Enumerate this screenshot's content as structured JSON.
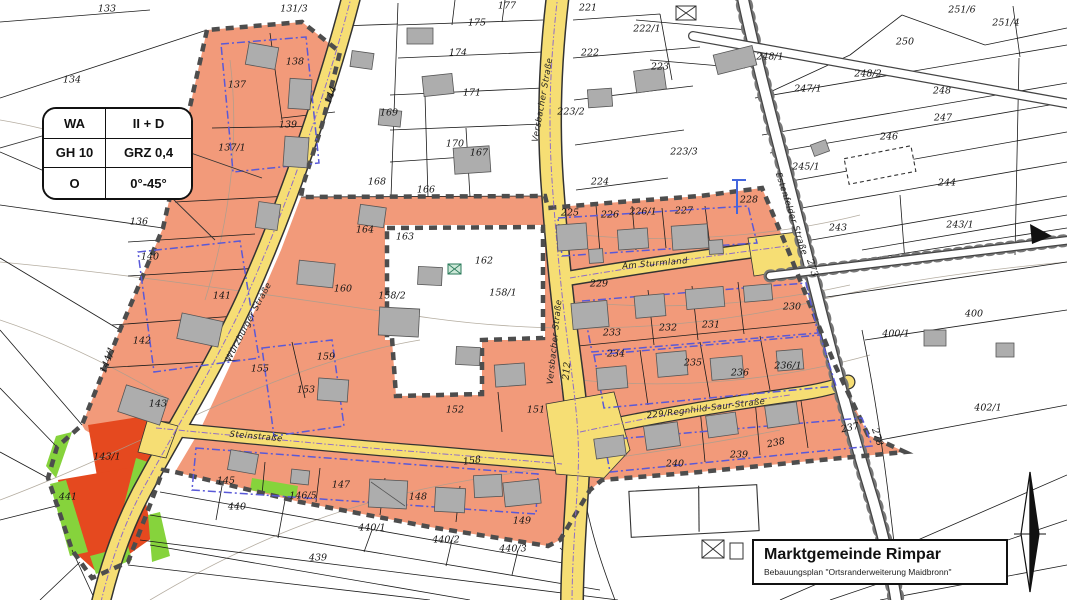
{
  "map": {
    "title_block": {
      "municipality": "Marktgemeinde Rimpar",
      "plan_name": "Bebauungsplan \"Ortsranderweiterung Maidbronn\""
    },
    "legend": {
      "rows": [
        [
          "WA",
          "II + D"
        ],
        [
          "GH 10",
          "GRZ 0,4"
        ],
        [
          "O",
          "0°-45°"
        ]
      ]
    },
    "colors": {
      "zone_orange": "#F29A7A",
      "zone_red": "#E5491F",
      "green_strip": "#86D33C",
      "street_yellow": "#F6DE74",
      "baugrenze_blue": "#5959D8",
      "utility_violet": "#8F6CC8",
      "boundary_gray": "#4D4D4D",
      "building_gray": "#ADADAD"
    },
    "street_labels": [
      {
        "t": "Versbacher Straße",
        "x": 543,
        "y": 100,
        "r": -80
      },
      {
        "t": "Versbacher Straße",
        "x": 555,
        "y": 342,
        "r": -84
      },
      {
        "t": "Würzburger Straße",
        "x": 249,
        "y": 322,
        "r": -62
      },
      {
        "t": "Steinstraße",
        "x": 256,
        "y": 437,
        "r": 5
      },
      {
        "t": "Am Sturmland",
        "x": 655,
        "y": 264,
        "r": -5
      },
      {
        "t": "229/Regnhild-Saur-Straße",
        "x": 706,
        "y": 409,
        "r": -7
      },
      {
        "t": "Estenfelder Straße",
        "x": 791,
        "y": 214,
        "r": 72
      }
    ],
    "parcel_labels": [
      {
        "t": "133",
        "x": 107,
        "y": 9
      },
      {
        "t": "134",
        "x": 72,
        "y": 80
      },
      {
        "t": "131/3",
        "x": 294,
        "y": 9
      },
      {
        "t": "177",
        "x": 507,
        "y": 6
      },
      {
        "t": "175",
        "x": 477,
        "y": 23
      },
      {
        "t": "174",
        "x": 458,
        "y": 53
      },
      {
        "t": "171",
        "x": 472,
        "y": 93
      },
      {
        "t": "169",
        "x": 389,
        "y": 113
      },
      {
        "t": "170",
        "x": 455,
        "y": 144
      },
      {
        "t": "167",
        "x": 479,
        "y": 153
      },
      {
        "t": "168",
        "x": 377,
        "y": 182
      },
      {
        "t": "166",
        "x": 426,
        "y": 190
      },
      {
        "t": "221",
        "x": 588,
        "y": 8
      },
      {
        "t": "222",
        "x": 590,
        "y": 53
      },
      {
        "t": "222/1",
        "x": 647,
        "y": 29
      },
      {
        "t": "223",
        "x": 660,
        "y": 67
      },
      {
        "t": "223/2",
        "x": 571,
        "y": 112
      },
      {
        "t": "223/3",
        "x": 684,
        "y": 152
      },
      {
        "t": "224",
        "x": 600,
        "y": 182
      },
      {
        "t": "248/1",
        "x": 770,
        "y": 57
      },
      {
        "t": "247/1",
        "x": 808,
        "y": 89
      },
      {
        "t": "251/6",
        "x": 962,
        "y": 10
      },
      {
        "t": "251/4",
        "x": 1006,
        "y": 23
      },
      {
        "t": "250",
        "x": 905,
        "y": 42
      },
      {
        "t": "248/2",
        "x": 868,
        "y": 74
      },
      {
        "t": "248",
        "x": 942,
        "y": 91
      },
      {
        "t": "247",
        "x": 943,
        "y": 118
      },
      {
        "t": "246",
        "x": 889,
        "y": 137
      },
      {
        "t": "245/1",
        "x": 806,
        "y": 167
      },
      {
        "t": "244",
        "x": 947,
        "y": 183
      },
      {
        "t": "243",
        "x": 838,
        "y": 228
      },
      {
        "t": "243/1",
        "x": 960,
        "y": 225
      },
      {
        "t": "400",
        "x": 974,
        "y": 314
      },
      {
        "t": "400/1",
        "x": 896,
        "y": 334
      },
      {
        "t": "402/1",
        "x": 988,
        "y": 408
      },
      {
        "t": "137",
        "x": 237,
        "y": 85
      },
      {
        "t": "138",
        "x": 295,
        "y": 62
      },
      {
        "t": "139",
        "x": 288,
        "y": 125
      },
      {
        "t": "137/1",
        "x": 232,
        "y": 148
      },
      {
        "t": "136",
        "x": 139,
        "y": 222
      },
      {
        "t": "140",
        "x": 150,
        "y": 257
      },
      {
        "t": "141",
        "x": 222,
        "y": 296
      },
      {
        "t": "142",
        "x": 142,
        "y": 341
      },
      {
        "t": "143",
        "x": 158,
        "y": 404
      },
      {
        "t": "143/1",
        "x": 107,
        "y": 457
      },
      {
        "t": "441",
        "x": 68,
        "y": 497
      },
      {
        "t": "144",
        "x": 331,
        "y": 95,
        "r": -70
      },
      {
        "t": "144/1",
        "x": 108,
        "y": 360,
        "r": -70
      },
      {
        "t": "164",
        "x": 365,
        "y": 230
      },
      {
        "t": "163",
        "x": 405,
        "y": 237
      },
      {
        "t": "162",
        "x": 484,
        "y": 261
      },
      {
        "t": "160",
        "x": 343,
        "y": 289
      },
      {
        "t": "159",
        "x": 326,
        "y": 357
      },
      {
        "t": "158/2",
        "x": 392,
        "y": 296
      },
      {
        "t": "158/1",
        "x": 503,
        "y": 293
      },
      {
        "t": "155",
        "x": 260,
        "y": 369
      },
      {
        "t": "153",
        "x": 306,
        "y": 390
      },
      {
        "t": "152",
        "x": 455,
        "y": 410
      },
      {
        "t": "151",
        "x": 536,
        "y": 410
      },
      {
        "t": "145",
        "x": 226,
        "y": 481
      },
      {
        "t": "146/5",
        "x": 303,
        "y": 496
      },
      {
        "t": "147",
        "x": 341,
        "y": 485
      },
      {
        "t": "148",
        "x": 418,
        "y": 497
      },
      {
        "t": "149",
        "x": 522,
        "y": 521
      },
      {
        "t": "158",
        "x": 472,
        "y": 461,
        "r": -8
      },
      {
        "t": "440",
        "x": 237,
        "y": 507
      },
      {
        "t": "440/1",
        "x": 372,
        "y": 528
      },
      {
        "t": "440/2",
        "x": 446,
        "y": 540
      },
      {
        "t": "440/3",
        "x": 513,
        "y": 549
      },
      {
        "t": "439",
        "x": 318,
        "y": 558
      },
      {
        "t": "225",
        "x": 570,
        "y": 213
      },
      {
        "t": "226",
        "x": 610,
        "y": 215
      },
      {
        "t": "226/1",
        "x": 643,
        "y": 212
      },
      {
        "t": "227",
        "x": 684,
        "y": 211
      },
      {
        "t": "228",
        "x": 749,
        "y": 200
      },
      {
        "t": "229",
        "x": 599,
        "y": 284
      },
      {
        "t": "230",
        "x": 792,
        "y": 307
      },
      {
        "t": "231",
        "x": 711,
        "y": 325
      },
      {
        "t": "232",
        "x": 668,
        "y": 328
      },
      {
        "t": "233",
        "x": 612,
        "y": 333
      },
      {
        "t": "234",
        "x": 616,
        "y": 354
      },
      {
        "t": "235",
        "x": 693,
        "y": 363
      },
      {
        "t": "236",
        "x": 740,
        "y": 373
      },
      {
        "t": "236/1",
        "x": 788,
        "y": 366
      },
      {
        "t": "240",
        "x": 675,
        "y": 464
      },
      {
        "t": "239",
        "x": 739,
        "y": 455
      },
      {
        "t": "238",
        "x": 776,
        "y": 443,
        "r": -12
      },
      {
        "t": "237",
        "x": 850,
        "y": 428,
        "r": -12
      },
      {
        "t": "273",
        "x": 812,
        "y": 268,
        "r": 72
      },
      {
        "t": "278",
        "x": 877,
        "y": 437,
        "r": 72
      },
      {
        "t": "212",
        "x": 567,
        "y": 371,
        "r": -84
      }
    ]
  }
}
